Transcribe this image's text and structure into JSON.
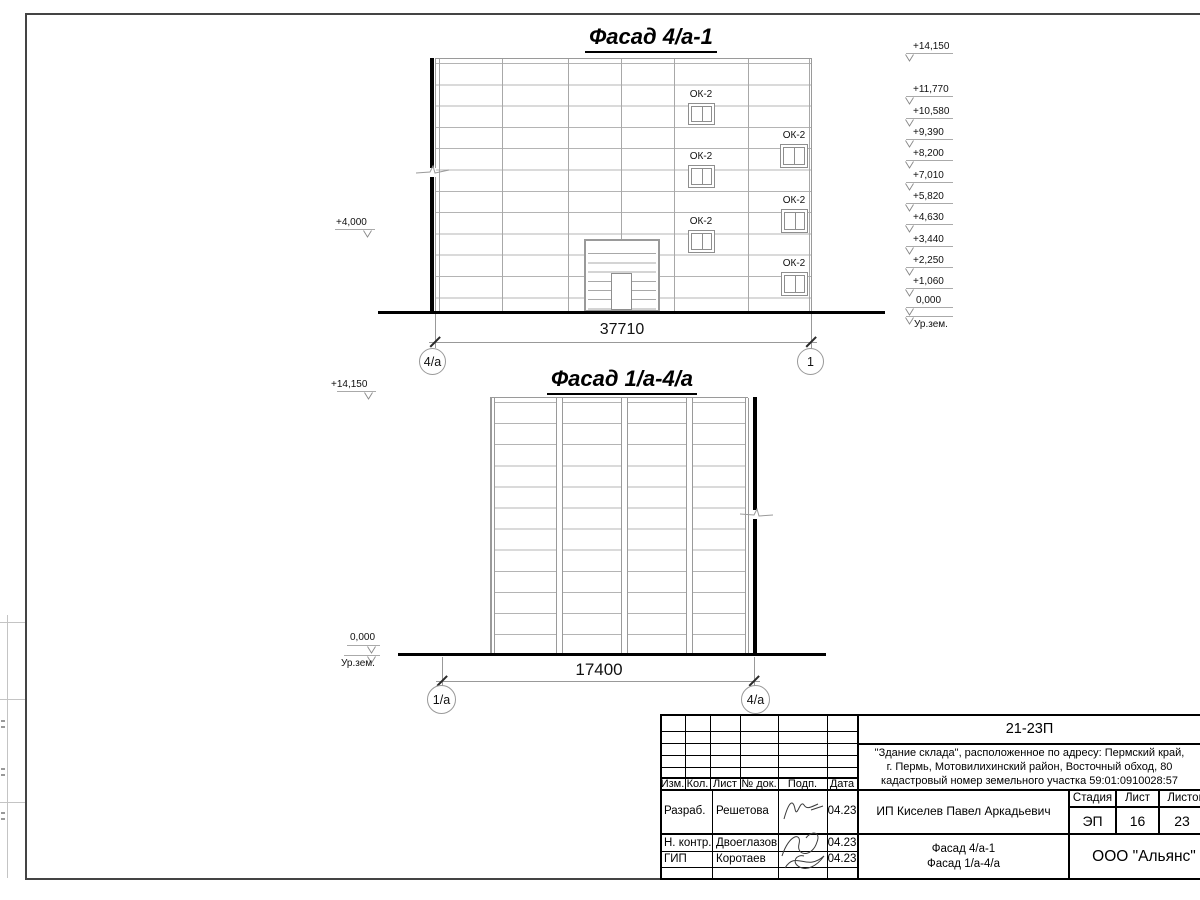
{
  "colors": {
    "paper": "#ffffff",
    "ink": "#1a1a1a",
    "panel_line": "#b4b4b4",
    "mid_line": "#999999"
  },
  "facade1": {
    "title": "Фасад 4/а-1",
    "window_label": "ОК-2",
    "dimension": "37710",
    "axis_left": "4/a",
    "axis_right": "1",
    "mark_left": "+4,000",
    "marks": [
      "+14,150",
      "+11,770",
      "+10,580",
      "+9,390",
      "+8,200",
      "+7,010",
      "+5,820",
      "+4,630",
      "+3,440",
      "+2,250",
      "+1,060",
      "0,000"
    ],
    "ground_label": "Ур.зем."
  },
  "facade2": {
    "title": "Фасад 1/а-4/а",
    "dimension": "17400",
    "axis_left": "1/a",
    "axis_right": "4/a",
    "mark_top": "+14,150",
    "mark_zero": "0,000",
    "ground_label": "Ур.зем."
  },
  "titleblock": {
    "code": "21-23П",
    "address_lines": [
      "\"Здание склада\", расположенное по адресу: Пермский край,",
      "г. Пермь, Мотовилихинский район, Восточный обход, 80",
      "кадастровый номер земельного участка 59:01:0910028:57"
    ],
    "cols": [
      "Изм.",
      "Кол.",
      "Лист",
      "№ док.",
      "Подп.",
      "Дата"
    ],
    "rows": [
      {
        "role": "Разраб.",
        "name": "Решетова",
        "date": "04.23"
      },
      {
        "role": "Н. контр.",
        "name": "Двоеглазов",
        "date": "04.23"
      },
      {
        "role": "ГИП",
        "name": "Коротаев",
        "date": "04.23"
      }
    ],
    "client": "ИП Киселев Павел Аркадьевич",
    "stage_label": "Стадия",
    "sheet_label": "Лист",
    "sheets_label": "Листов",
    "stage": "ЭП",
    "sheet_no": "16",
    "sheets_total": "23",
    "doc_titles": [
      "Фасад 4/а-1",
      "Фасад 1/а-4/а"
    ],
    "org": "ООО \"Альянс\""
  }
}
